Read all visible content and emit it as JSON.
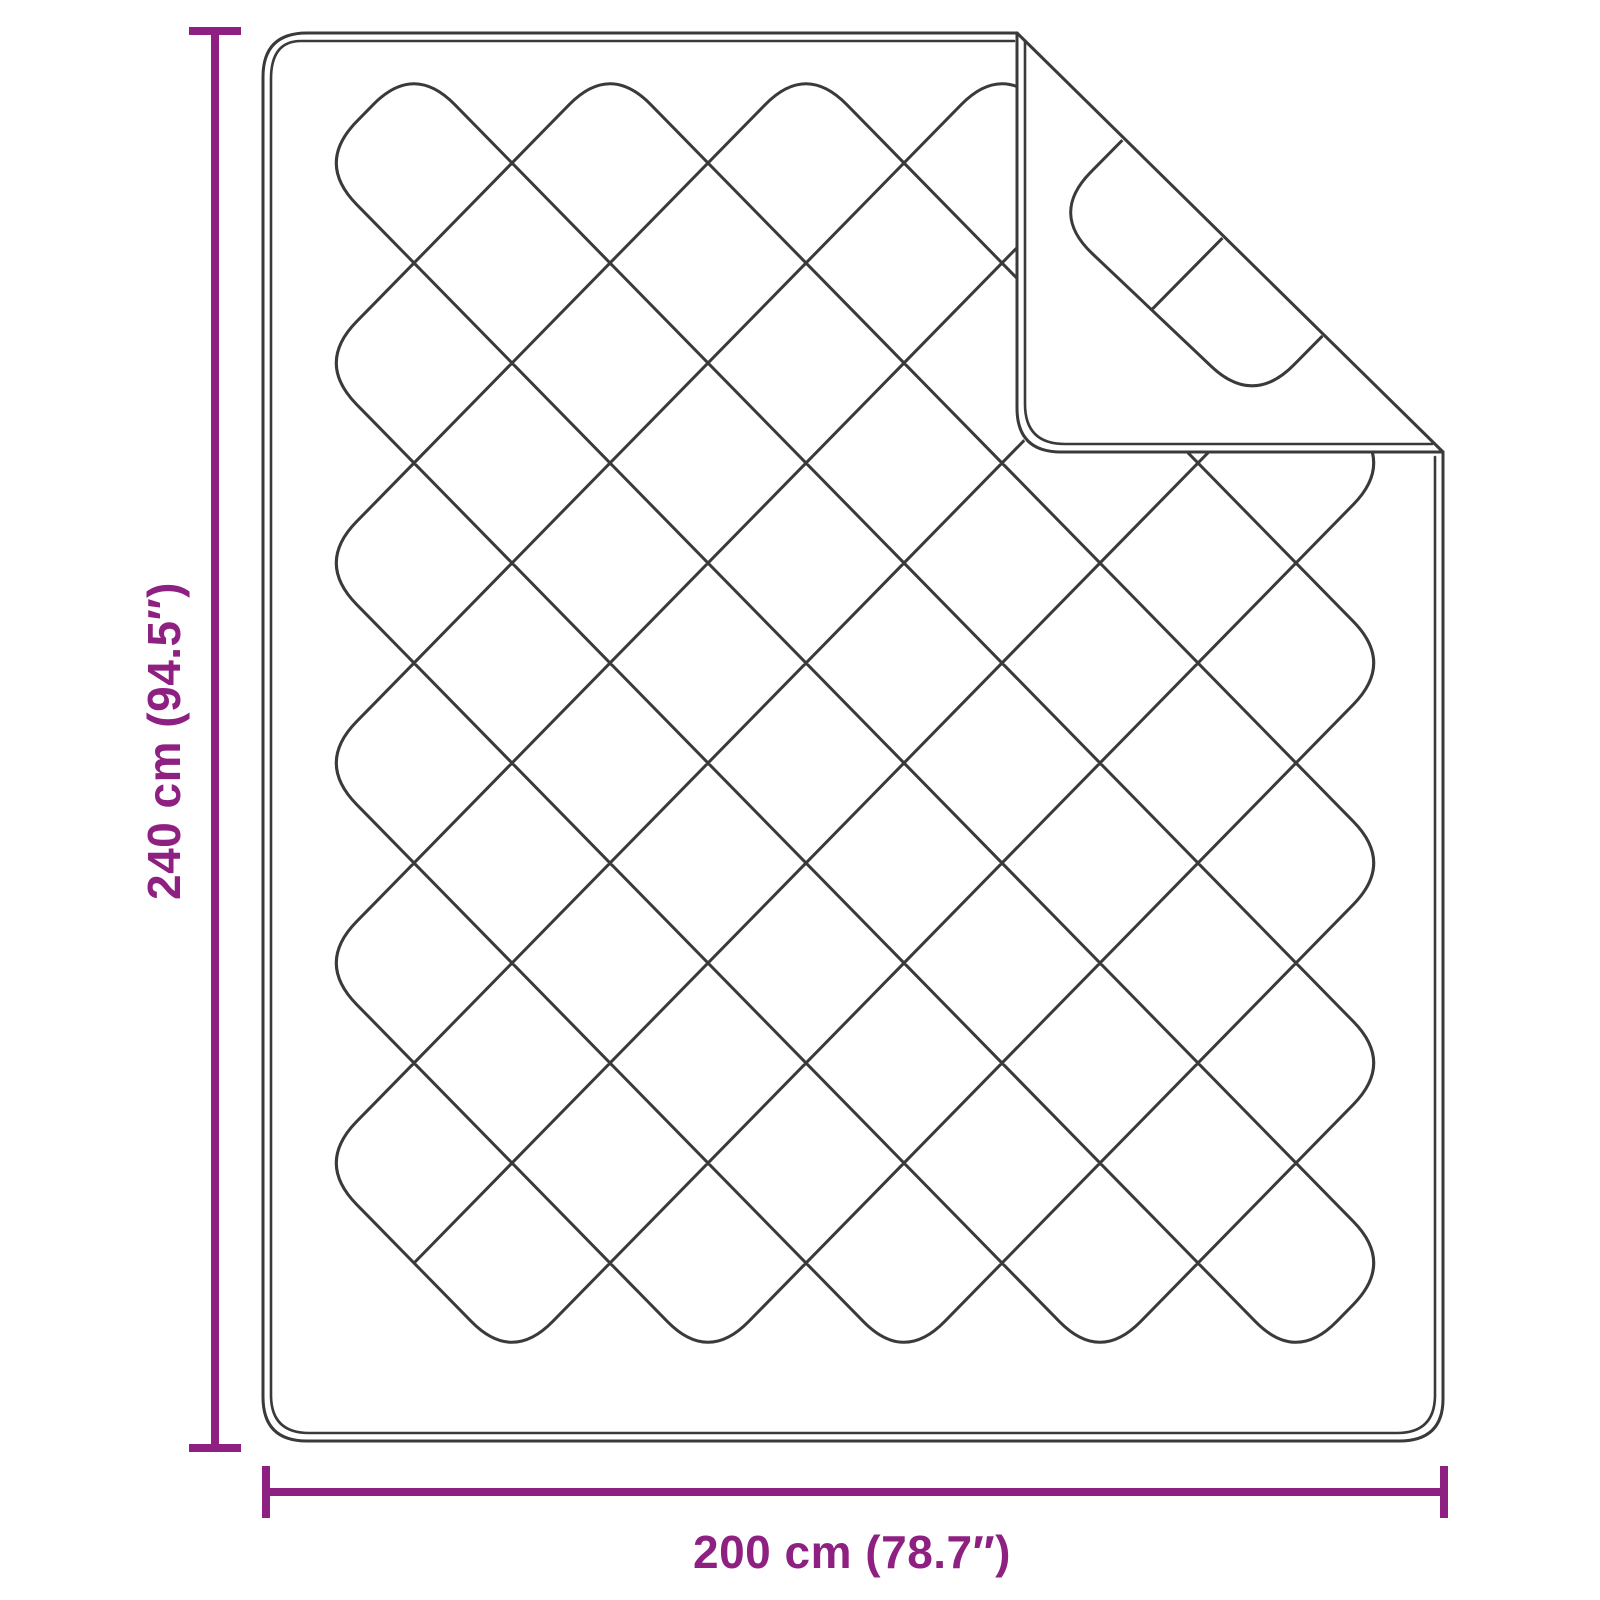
{
  "page": {
    "background": "#ffffff",
    "description": "Dimension diagram of a quilted blanket (top view) with folded top-right corner"
  },
  "colors": {
    "accent": "#8e2082",
    "line": "#3a3a3a",
    "paper": "#ffffff",
    "background": "#ffffff"
  },
  "dimensions": {
    "height": {
      "label": "240 cm (94.5″)",
      "value_cm": 240,
      "value_in": 94.5
    },
    "width": {
      "label": "200 cm (78.7″)",
      "value_cm": 200,
      "value_in": 78.7
    }
  },
  "diagram": {
    "subject": "quilted-blanket",
    "folded_corner": "top-right",
    "lattice": {
      "L": 316,
      "T": 63,
      "hx": 98,
      "hy": 100,
      "nu": 11,
      "nv": 13,
      "trim": 58,
      "cornerTrim": 140
    }
  }
}
